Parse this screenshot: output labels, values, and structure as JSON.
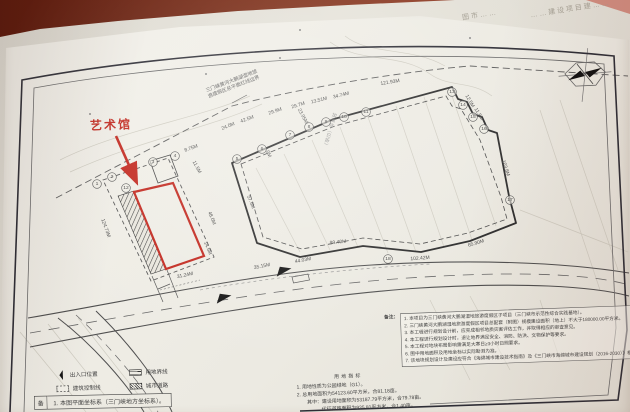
{
  "photo": {
    "back_sheet_fragments": [
      "图市……",
      "……建设项目建……"
    ]
  },
  "plan": {
    "art_museum_label": "艺术馆",
    "boundary_note": [
      "三门峡黄河大鹏湖湿地旅",
      "游度假区总平面红线边界"
    ],
    "station_label": "加油站（已拆）",
    "dims": [
      {
        "t": "121.93M",
        "x": 390,
        "y": 82,
        "r": -9
      },
      {
        "t": "34.74M",
        "x": 341,
        "y": 95,
        "r": -14
      },
      {
        "t": "13.51M",
        "x": 319,
        "y": 100,
        "r": -14
      },
      {
        "t": "23.95M",
        "x": 303,
        "y": 116,
        "r": 62
      },
      {
        "t": "29.7M",
        "x": 298,
        "y": 105,
        "r": -17
      },
      {
        "t": "29.9M",
        "x": 275,
        "y": 111,
        "r": -19
      },
      {
        "t": "42.5M",
        "x": 247,
        "y": 119,
        "r": -20
      },
      {
        "t": "24.0M",
        "x": 228,
        "y": 126,
        "r": -22
      },
      {
        "t": "8.75M",
        "x": 191,
        "y": 148,
        "r": -20
      },
      {
        "t": "11.5M",
        "x": 197,
        "y": 167,
        "r": 62
      },
      {
        "t": "12.5M",
        "x": 470,
        "y": 101,
        "r": 60
      },
      {
        "t": "11.5M",
        "x": 479,
        "y": 114,
        "r": 60
      },
      {
        "t": "103.8M",
        "x": 506,
        "y": 168,
        "r": 72
      },
      {
        "t": "57.5M",
        "x": 251,
        "y": 202,
        "r": 68
      },
      {
        "t": "3.0M",
        "x": 268,
        "y": 152,
        "r": 68
      },
      {
        "t": "102.42M",
        "x": 420,
        "y": 258,
        "r": -4
      },
      {
        "t": "44.03M",
        "x": 303,
        "y": 260,
        "r": -10
      },
      {
        "t": "35.15M",
        "x": 262,
        "y": 266,
        "r": -11
      },
      {
        "t": "65.90M",
        "x": 476,
        "y": 243,
        "r": -17
      },
      {
        "t": "99.40M",
        "x": 338,
        "y": 242,
        "r": -6
      },
      {
        "t": "124.73M",
        "x": 106,
        "y": 228,
        "r": 70
      },
      {
        "t": "31.24M",
        "x": 185,
        "y": 275,
        "r": -12
      },
      {
        "t": "48.0M",
        "x": 212,
        "y": 218,
        "r": 68
      },
      {
        "t": "14.5M",
        "x": 208,
        "y": 248,
        "r": 68
      }
    ],
    "axes": [
      {
        "n": "1",
        "x": 97,
        "y": 184
      },
      {
        "n": "2",
        "x": 112,
        "y": 177
      },
      {
        "n": "12",
        "x": 126,
        "y": 188
      },
      {
        "n": "3",
        "x": 153,
        "y": 162
      },
      {
        "n": "4",
        "x": 175,
        "y": 156
      },
      {
        "n": "5",
        "x": 237,
        "y": 159
      },
      {
        "n": "6",
        "x": 262,
        "y": 149
      },
      {
        "n": "7",
        "x": 290,
        "y": 135
      },
      {
        "n": "8",
        "x": 309,
        "y": 127
      },
      {
        "n": "9",
        "x": 326,
        "y": 122
      },
      {
        "n": "10",
        "x": 344,
        "y": 117
      },
      {
        "n": "11",
        "x": 366,
        "y": 112
      },
      {
        "n": "13",
        "x": 452,
        "y": 92
      },
      {
        "n": "14",
        "x": 463,
        "y": 105
      },
      {
        "n": "15",
        "x": 473,
        "y": 117
      },
      {
        "n": "16",
        "x": 484,
        "y": 129
      },
      {
        "n": "17",
        "x": 510,
        "y": 200
      },
      {
        "n": "18",
        "x": 388,
        "y": 259
      }
    ]
  },
  "legend": {
    "items": [
      {
        "icon": "entrance-arrow",
        "label": "出入口位置"
      },
      {
        "icon": "site-boundary",
        "label": "用地界线"
      },
      {
        "icon": "building-control-line",
        "label": "建筑控制线"
      },
      {
        "icon": "city-road",
        "label": "城市道路"
      }
    ]
  },
  "indicators": {
    "title": "用地指标",
    "lines": [
      "1. 用地性质为公园绿地（G1）。",
      "2. 总用地面积为54123.60平方米，合81.18亩。",
      "其中：建设用地面积为53187.79平方米，合79.78亩。",
      "代征道路面积为935.81平方米，合1.40亩。"
    ]
  },
  "notes": {
    "title": "备注：",
    "lines": [
      "1. 本项目为三门峡黄河大鹏湖湿地旅游度假区子项目（三门峡市示范性综合实践基地）。",
      "2. 三门峡黄河大鹏湖湿地旅游度假区项目总配套（附图）规模建设面积（地上）不大于180000.00平方米。",
      "3. 本工程进行规划设计前，应完成相邻地质灾害评估工作，并取得相应的审查意见。",
      "4. 本工程进行规划设计时，退让地界满足安全、消防、防洪、文物保护等要求。",
      "5. 本工程对地块布局影响需满足大寒日≥3小时日照要求。",
      "6. 图中用地面积及用地坐标以实际勘测为准。",
      "7. 该地块规划设计及建设应符合《海绵城市建设技术指南》及《三门峡市海绵城市建设规划（2016-2030）》相关要求。"
    ]
  },
  "footer": {
    "label": "备",
    "text": "1. 本图平面坐标系（三门峡地方坐标系）。"
  },
  "colors": {
    "accent_red": "#c2281e",
    "wood_brown": "#7c2e18",
    "paper": "#f1efe8"
  }
}
